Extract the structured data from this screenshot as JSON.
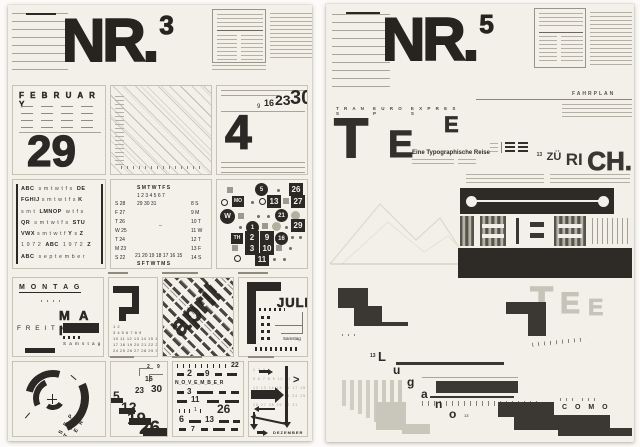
{
  "colors": {
    "ink": "#2b2825",
    "paper": "#f2f0e8",
    "dark_block": "#3b3834",
    "gray_block": "#c9c7bb"
  },
  "left": {
    "title": "NR.",
    "sup": "3",
    "february": {
      "month": "F E B R U A R Y",
      "day": "29"
    },
    "week": {
      "big": "4",
      "stamps": [
        {
          "t": "9",
          "x": 40,
          "y": 18,
          "fs": 6
        },
        {
          "t": "16",
          "x": 47,
          "y": 13,
          "fs": 9,
          "b": 1
        },
        {
          "t": "23",
          "x": 58,
          "y": 7,
          "fs": 14,
          "b": 1
        },
        {
          "t": "30",
          "x": 73,
          "y": 2,
          "fs": 20,
          "b": 1
        }
      ]
    },
    "alphabet": {
      "rows": [
        [
          [
            "ABC",
            1
          ],
          [
            "  s m t w t f s  ",
            0
          ],
          [
            "DE",
            1
          ]
        ],
        [
          [
            "FGHIJ",
            1
          ],
          [
            " s m t w t f s ",
            0
          ],
          [
            "K",
            1
          ]
        ],
        [
          [
            "s m t  ",
            0
          ],
          [
            "LMNOP",
            1
          ],
          [
            "  w t f s",
            0
          ]
        ],
        [
          [
            "QR",
            1
          ],
          [
            "  s m t w t f s  ",
            0
          ],
          [
            "STU",
            1
          ]
        ],
        [
          [
            "VWX",
            1
          ],
          [
            " s m t w t f ",
            0
          ],
          [
            "Y",
            1
          ],
          [
            " s ",
            0
          ],
          [
            "Z",
            1
          ]
        ],
        [
          [
            "1 9 7 2  ",
            0
          ],
          [
            "ABC",
            1
          ],
          [
            "  1 9 7 2  ",
            0
          ],
          [
            "Z",
            1
          ]
        ],
        [
          [
            "ABC",
            1
          ],
          [
            "  s e p t e m b e r",
            0
          ]
        ]
      ]
    },
    "ring": {
      "stamps": [
        {
          "t": "S M T W T F S",
          "x": 26,
          "y": 6,
          "b": 1
        },
        {
          "t": "1 2 3 4 5 6 7",
          "x": 26,
          "y": 14
        },
        {
          "t": "29 30 31",
          "x": 26,
          "y": 22
        },
        {
          "t": "S 28",
          "x": 4,
          "y": 22
        },
        {
          "t": "F 27",
          "x": 4,
          "y": 31
        },
        {
          "t": "T 26",
          "x": 4,
          "y": 40
        },
        {
          "t": "W 25",
          "x": 4,
          "y": 49
        },
        {
          "t": "T 24",
          "x": 4,
          "y": 58
        },
        {
          "t": "M 23",
          "x": 4,
          "y": 67
        },
        {
          "t": "S 22",
          "x": 4,
          "y": 76
        },
        {
          "t": "8 S",
          "x": 80,
          "y": 22
        },
        {
          "t": "9 M",
          "x": 80,
          "y": 31
        },
        {
          "t": "10 T",
          "x": 80,
          "y": 40
        },
        {
          "t": "11 W",
          "x": 80,
          "y": 49
        },
        {
          "t": "12 T",
          "x": 80,
          "y": 58
        },
        {
          "t": "13 F",
          "x": 80,
          "y": 67
        },
        {
          "t": "14 S",
          "x": 80,
          "y": 76
        },
        {
          "t": "21 20 19 18 17 16 15",
          "x": 24,
          "y": 74
        },
        {
          "t": "S F T W T M S",
          "x": 26,
          "y": 82,
          "b": 1
        },
        {
          "t": "–",
          "x": 48,
          "y": 44
        }
      ]
    },
    "badges": {
      "stamps": [
        {
          "k": "gsq",
          "x": 10,
          "y": 7
        },
        {
          "t": "5",
          "k": "cir",
          "x": 38,
          "y": 3
        },
        {
          "k": "dot",
          "x": 60,
          "y": 9
        },
        {
          "t": "26",
          "k": "sqb",
          "x": 72,
          "y": 3
        },
        {
          "k": "cis",
          "x": 4,
          "y": 19
        },
        {
          "t": "MO",
          "k": "sqd",
          "x": 15,
          "y": 16
        },
        {
          "k": "dot",
          "x": 34,
          "y": 21
        },
        {
          "k": "cis",
          "x": 42,
          "y": 18
        },
        {
          "t": "13",
          "k": "sqb",
          "x": 50,
          "y": 15
        },
        {
          "k": "gsq",
          "x": 66,
          "y": 18
        },
        {
          "t": "27",
          "k": "sqb",
          "x": 74,
          "y": 15
        },
        {
          "t": "W",
          "k": "cib",
          "x": 3,
          "y": 29
        },
        {
          "k": "gsq",
          "x": 21,
          "y": 33
        },
        {
          "k": "dot",
          "x": 40,
          "y": 35
        },
        {
          "k": "dot",
          "x": 50,
          "y": 35
        },
        {
          "t": "21",
          "k": "cir",
          "x": 58,
          "y": 29
        },
        {
          "k": "gci",
          "x": 74,
          "y": 31
        },
        {
          "k": "dot",
          "x": 22,
          "y": 46
        },
        {
          "t": "1",
          "k": "cir",
          "x": 29,
          "y": 41
        },
        {
          "k": "gsq",
          "x": 45,
          "y": 43
        },
        {
          "k": "gci",
          "x": 55,
          "y": 42
        },
        {
          "k": "dot",
          "x": 68,
          "y": 46
        },
        {
          "t": "29",
          "k": "sqb",
          "x": 74,
          "y": 39
        },
        {
          "t": "TH",
          "k": "sqd",
          "x": 14,
          "y": 53
        },
        {
          "t": "2",
          "k": "sqb",
          "x": 28,
          "y": 51
        },
        {
          "t": "9",
          "k": "sqb",
          "x": 43,
          "y": 51
        },
        {
          "t": "16",
          "k": "cir",
          "x": 58,
          "y": 52
        },
        {
          "k": "dot",
          "x": 74,
          "y": 56
        },
        {
          "k": "dot",
          "x": 82,
          "y": 56
        },
        {
          "k": "gsq",
          "x": 15,
          "y": 65
        },
        {
          "t": "3",
          "k": "sqb",
          "x": 28,
          "y": 62
        },
        {
          "t": "10",
          "k": "sqb",
          "x": 43,
          "y": 62
        },
        {
          "k": "gsq",
          "x": 59,
          "y": 65
        },
        {
          "k": "dot",
          "x": 72,
          "y": 67
        },
        {
          "k": "cis",
          "x": 17,
          "y": 75
        },
        {
          "t": "11",
          "k": "sqb",
          "x": 38,
          "y": 73
        },
        {
          "k": "dot",
          "x": 56,
          "y": 78
        },
        {
          "k": "dot",
          "x": 66,
          "y": 78
        }
      ]
    },
    "montag": {
      "montag": "M O N T A G",
      "mai": "M A I",
      "freitag": "F R E I T A G",
      "samstag": "S a m s t a g"
    },
    "juni": {
      "lines": [
        "1 2",
        "3 4 5 6 7 8 9",
        "10 11 12 13 14 15 16",
        "17 18 19 20 21 22 23",
        "24 25 26 27 28 29 30"
      ]
    },
    "april": {
      "word": "april"
    },
    "juli": {
      "label": "JULI",
      "samstag": "Samstag"
    },
    "september": {
      "label": "S E P T E M B E R"
    },
    "stair": {
      "stamps": [
        {
          "t": "2",
          "x": 36,
          "y": 3,
          "fs": 5,
          "b": 1
        },
        {
          "t": "9",
          "x": 46,
          "y": 3,
          "fs": 5,
          "b": 1
        },
        {
          "t": "16",
          "x": 34,
          "y": 14,
          "fs": 7,
          "b": 1
        },
        {
          "t": "23",
          "x": 24,
          "y": 25,
          "fs": 8,
          "b": 1
        },
        {
          "t": "30",
          "x": 40,
          "y": 23,
          "fs": 10,
          "b": 1
        },
        {
          "t": "5",
          "x": 2,
          "y": 28,
          "fs": 12,
          "b": 1
        },
        {
          "t": "12",
          "x": 10,
          "y": 38,
          "fs": 14,
          "b": 1
        },
        {
          "t": "19",
          "x": 16,
          "y": 48,
          "fs": 17,
          "b": 1
        },
        {
          "t": "26",
          "x": 28,
          "y": 57,
          "fs": 19,
          "b": 1
        }
      ]
    },
    "november": {
      "stamps": [
        {
          "k": "tick",
          "x": 4,
          "y": 2
        },
        {
          "k": "tick",
          "x": 10,
          "y": 2
        },
        {
          "k": "tick",
          "x": 16,
          "y": 2
        },
        {
          "k": "tick",
          "x": 22,
          "y": 2
        },
        {
          "k": "tick",
          "x": 28,
          "y": 2
        },
        {
          "k": "tick",
          "x": 34,
          "y": 2
        },
        {
          "k": "tick",
          "x": 40,
          "y": 2
        },
        {
          "k": "tick",
          "x": 46,
          "y": 2
        },
        {
          "k": "tick",
          "x": 52,
          "y": 2
        },
        {
          "t": "22",
          "x": 58,
          "y": 0,
          "fs": 7,
          "b": 1
        },
        {
          "k": "nb",
          "x": 4,
          "y": 11
        },
        {
          "t": "2",
          "x": 14,
          "y": 7,
          "fs": 9,
          "b": 1
        },
        {
          "k": "nb",
          "x": 24,
          "y": 11
        },
        {
          "t": "9",
          "x": 32,
          "y": 8,
          "fs": 8,
          "b": 1
        },
        {
          "k": "nb",
          "x": 42,
          "y": 11
        },
        {
          "k": "nb",
          "x": 54,
          "y": 11,
          "w": 10
        },
        {
          "t": "N_O_V_E_M_B_E_R",
          "x": 2,
          "y": 19,
          "fs": 5,
          "b": 1
        },
        {
          "k": "nb",
          "x": 4,
          "y": 29
        },
        {
          "t": "3",
          "x": 14,
          "y": 26,
          "fs": 8,
          "b": 1
        },
        {
          "k": "nb",
          "x": 24,
          "y": 29,
          "w": 16
        },
        {
          "k": "nb",
          "x": 46,
          "y": 29
        },
        {
          "k": "nb",
          "x": 58,
          "y": 29,
          "w": 8
        },
        {
          "k": "nb",
          "x": 4,
          "y": 38,
          "w": 10
        },
        {
          "t": "11",
          "x": 18,
          "y": 34,
          "fs": 8,
          "b": 1
        },
        {
          "k": "nb",
          "x": 34,
          "y": 38,
          "w": 12
        },
        {
          "k": "nb",
          "x": 52,
          "y": 38,
          "w": 14
        },
        {
          "k": "tick",
          "x": 6,
          "y": 47
        },
        {
          "k": "tick",
          "x": 11,
          "y": 47
        },
        {
          "k": "tick",
          "x": 16,
          "y": 47
        },
        {
          "t": "1",
          "x": 21,
          "y": 46,
          "fs": 5
        },
        {
          "k": "tick",
          "x": 27,
          "y": 47
        },
        {
          "t": "26",
          "x": 44,
          "y": 41,
          "fs": 12,
          "b": 1
        },
        {
          "t": "6",
          "x": 6,
          "y": 53,
          "fs": 9,
          "b": 1
        },
        {
          "k": "nb",
          "x": 16,
          "y": 58,
          "w": 12
        },
        {
          "t": "13",
          "x": 32,
          "y": 54,
          "fs": 8,
          "b": 1
        },
        {
          "k": "nb",
          "x": 46,
          "y": 58,
          "w": 10
        },
        {
          "k": "nb",
          "x": 60,
          "y": 58
        },
        {
          "k": "nb",
          "x": 6,
          "y": 66
        },
        {
          "t": "7",
          "x": 18,
          "y": 64,
          "fs": 7,
          "b": 1
        },
        {
          "k": "nb",
          "x": 28,
          "y": 66
        },
        {
          "k": "nb",
          "x": 40,
          "y": 66,
          "w": 12
        },
        {
          "k": "nb",
          "x": 58,
          "y": 66
        }
      ]
    },
    "dezember": {
      "label": "DEZEMBER",
      "grid": [
        "1 2 3 4",
        "5 6 7 8 9 10 11",
        "12 13 14 15 16 17 18",
        "19 20 21 22 23 24 25",
        "26 27 28 29 30 31"
      ]
    }
  },
  "right": {
    "title": "NR.",
    "sup": "5",
    "fahrplan": "FAHRPLAN",
    "kicker": [
      "T R A N S",
      "E U R O P",
      "E X P R E S S"
    ],
    "tee": {
      "t": "T",
      "e1": "E",
      "e2": "E",
      "subtitle": "Eine Typographische Reise"
    },
    "zurich": {
      "sup": "13",
      "zu": "ZÜ",
      "ri": "RI",
      "ch": "CH."
    },
    "lugano": {
      "stamps": [
        {
          "t": "13",
          "x": 44,
          "y": 74,
          "fs": 5,
          "b": 1
        },
        {
          "t": "L",
          "x": 52,
          "y": 70,
          "fs": 13,
          "b": 1
        },
        {
          "t": "u",
          "x": 67,
          "y": 84,
          "fs": 12,
          "b": 1
        },
        {
          "t": "g",
          "x": 81,
          "y": 96,
          "fs": 12,
          "b": 1
        },
        {
          "t": "a",
          "x": 95,
          "y": 108,
          "fs": 12,
          "b": 1
        },
        {
          "t": "n",
          "x": 109,
          "y": 118,
          "fs": 12,
          "b": 1
        },
        {
          "t": "o",
          "x": 123,
          "y": 128,
          "fs": 12,
          "b": 1
        },
        {
          "t": "13",
          "x": 138,
          "y": 134,
          "fs": 4
        }
      ]
    },
    "como": "C O M O",
    "tee_gray": {
      "t": "T",
      "e1": "E",
      "e2": "E"
    }
  }
}
